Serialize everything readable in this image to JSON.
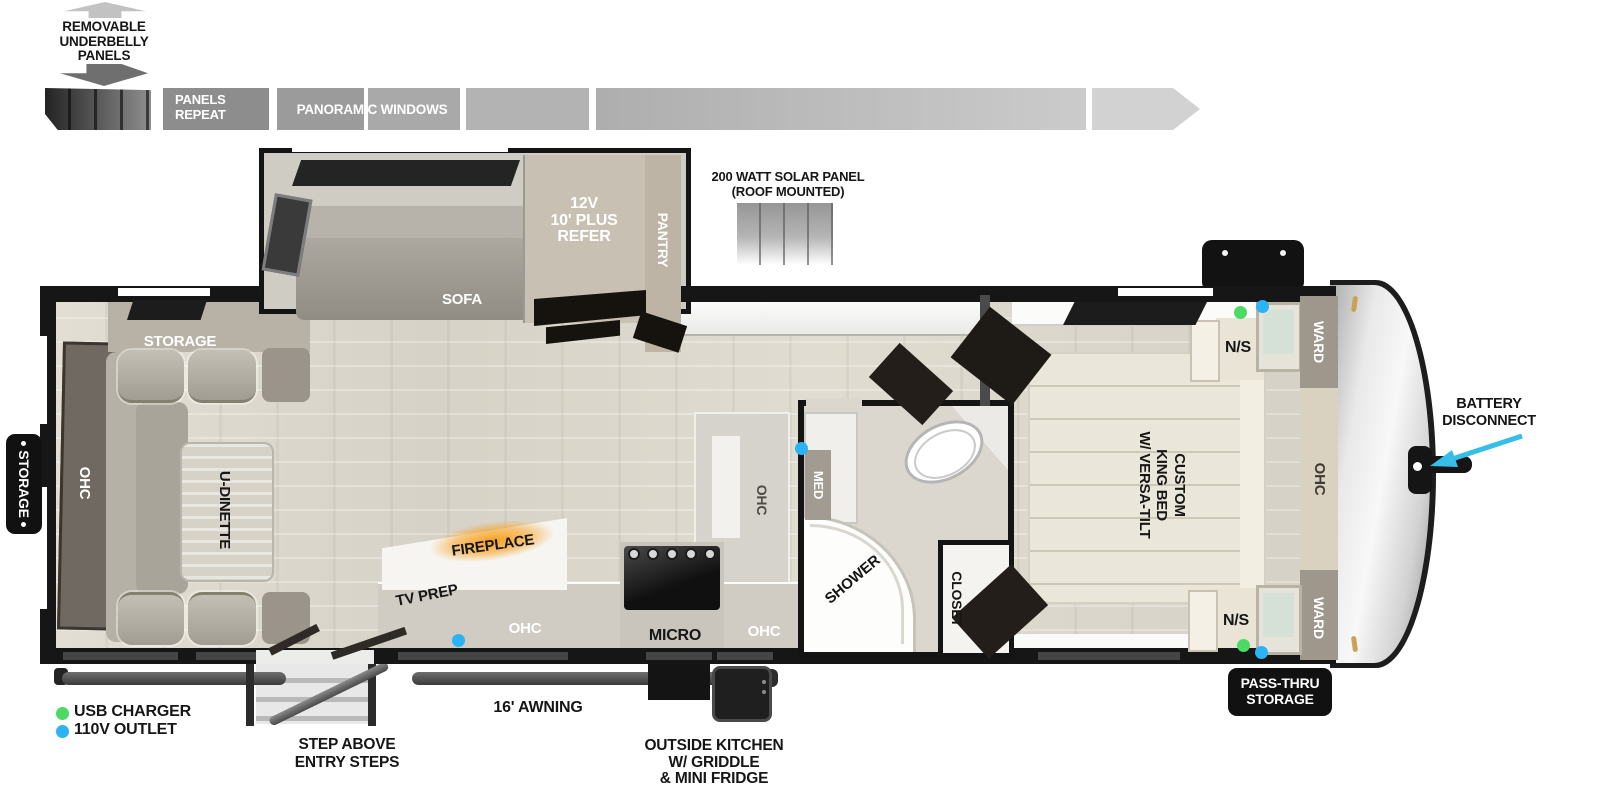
{
  "top_legend": {
    "removable_lines": [
      "REMOVABLE",
      "UNDERBELLY",
      "PANELS"
    ],
    "panels_repeat_lines": [
      "PANELS",
      "REPEAT"
    ],
    "panoramic_windows": "PANORAMIC WINDOWS"
  },
  "solar": {
    "lines": [
      "200 WATT SOLAR PANEL",
      "(ROOF MOUNTED)"
    ]
  },
  "exterior": {
    "storage_badge": "STORAGE",
    "pass_thru_lines": [
      "PASS-THRU",
      "STORAGE"
    ],
    "battery_lines": [
      "BATTERY",
      "DISCONNECT"
    ],
    "awning": "16' AWNING",
    "entry_steps_lines": [
      "STEP ABOVE",
      "ENTRY STEPS"
    ],
    "outside_kitchen_lines": [
      "OUTSIDE KITCHEN",
      "W/ GRIDDLE",
      "& MINI FRIDGE"
    ]
  },
  "interior": {
    "rear_storage": "STORAGE",
    "rear_ohc": "OHC",
    "dinette": "U-DINETTE",
    "sofa": "SOFA",
    "refer_lines": [
      "12V",
      "10' PLUS",
      "REFER"
    ],
    "pantry": "PANTRY",
    "fireplace": "FIREPLACE",
    "tv_prep": "TV PREP",
    "kitchen_ohc_left": "OHC",
    "kitchen_ohc_island": "OHC",
    "micro": "MICRO",
    "kitchen_ohc_right": "OHC",
    "med": "MED",
    "shower": "SHOWER",
    "closet": "CLOSET",
    "bed_lines": [
      "CUSTOM",
      "KING BED",
      "W/ VERSA-TILT"
    ],
    "ns_top": "N/S",
    "ns_bottom": "N/S",
    "ward_top": "WARD",
    "ward_bottom": "WARD",
    "front_ohc": "OHC"
  },
  "outlet_legend": {
    "usb": "USB CHARGER",
    "v110": "110V OUTLET"
  },
  "colors": {
    "usb_dot": "#4cd964",
    "outlet_dot": "#2bb3f3",
    "fireplace_glow": "#f7a11f",
    "arrow_cyan": "#36bde8"
  }
}
